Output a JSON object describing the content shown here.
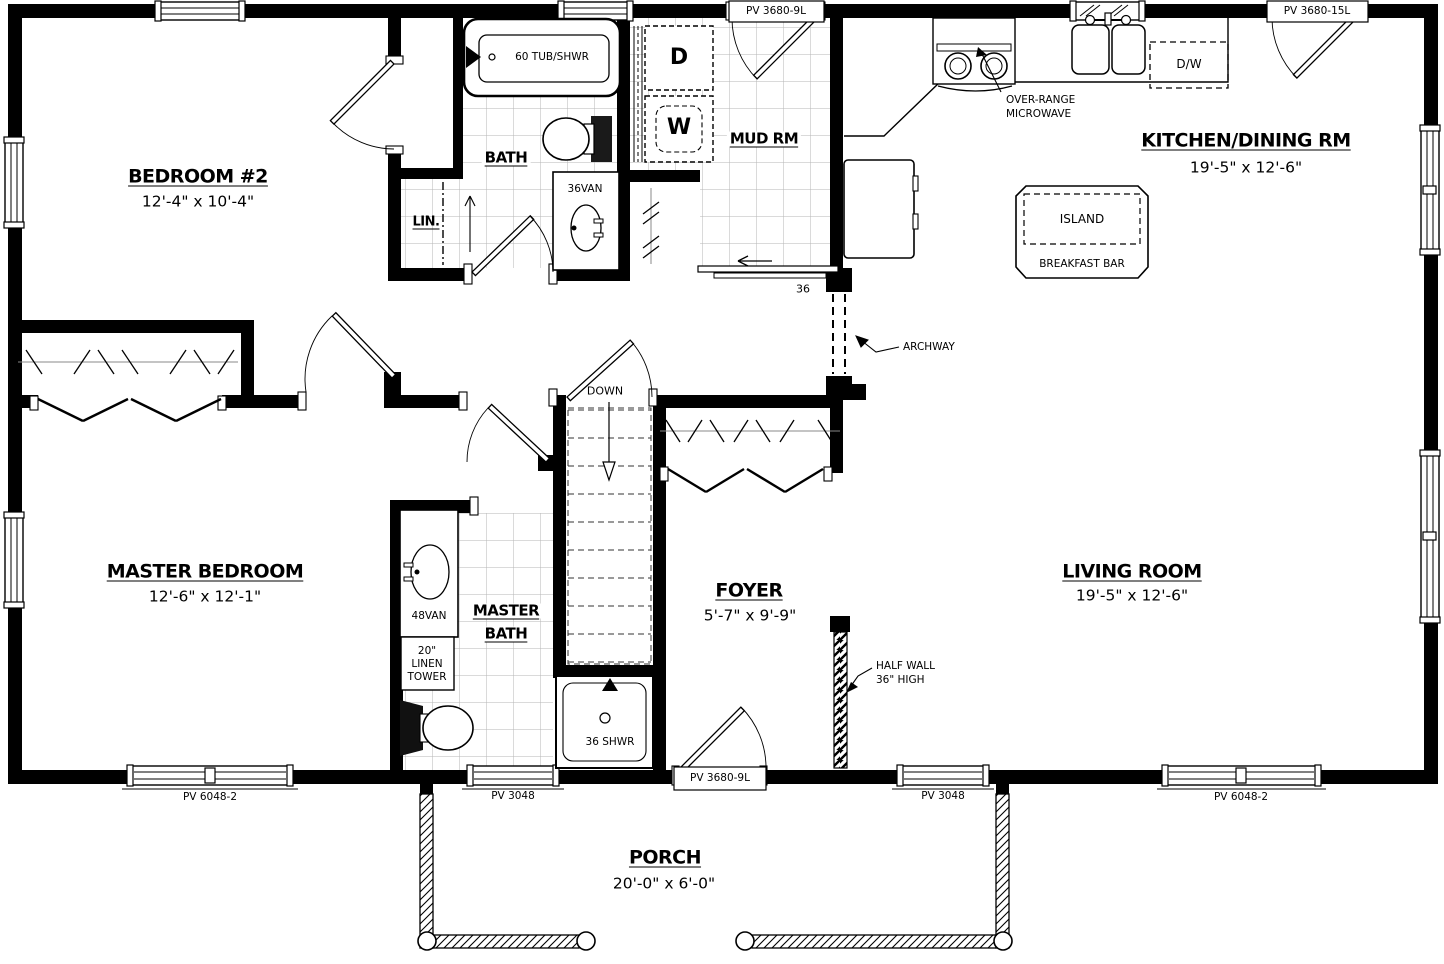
{
  "plan": {
    "background": "#ffffff",
    "line_color": "#000000",
    "tile_line_color": "#b5b5b5",
    "rooms": {
      "bedroom2": {
        "title": "BEDROOM #2",
        "dims": "12'-4\" x 10'-4\""
      },
      "bath": {
        "title": "BATH"
      },
      "lin_closet": {
        "title": "LIN."
      },
      "mud_room": {
        "title": "MUD RM"
      },
      "kitchen_dining": {
        "title": "KITCHEN/DINING RM",
        "dims": "19'-5\" x 12'-6\""
      },
      "master_bedroom": {
        "title": "MASTER BEDROOM",
        "dims": "12'-6\" x 12'-1\""
      },
      "master_bath": {
        "title_line1": "MASTER",
        "title_line2": "BATH"
      },
      "foyer": {
        "title": "FOYER",
        "dims": "5'-7\" x 9'-9\""
      },
      "living_room": {
        "title": "LIVING ROOM",
        "dims": "19'-5\" x 12'-6\""
      },
      "porch": {
        "title": "PORCH",
        "dims": "20'-0\" x 6'-0\""
      }
    },
    "fixtures": {
      "tub": "60 TUB/SHWR",
      "dryer": "D",
      "washer": "W",
      "vanity_36": "36VAN",
      "vanity_48": "48VAN",
      "linen_tower": [
        "20\"",
        "LINEN",
        "TOWER"
      ],
      "shower": "36 SHWR",
      "dishwasher": "D/W",
      "island": "ISLAND",
      "breakfast_bar": "BREAKFAST BAR"
    },
    "annotations": {
      "microwave": [
        "OVER-RANGE",
        "MICROWAVE"
      ],
      "archway": "ARCHWAY",
      "half_wall": [
        "HALF WALL",
        "36\" HIGH"
      ],
      "stairs": "DOWN",
      "pocket_door_width": "36"
    },
    "openings": {
      "mud_door": "PV 3680-9L",
      "kitchen_door": "PV 3680-15L",
      "master_bedroom_window": "PV 6048-2",
      "master_bath_window": "PV 3048",
      "foyer_door": "PV 3680-9L",
      "living_window_small": "PV 3048",
      "living_window_large": "PV 6048-2"
    }
  }
}
